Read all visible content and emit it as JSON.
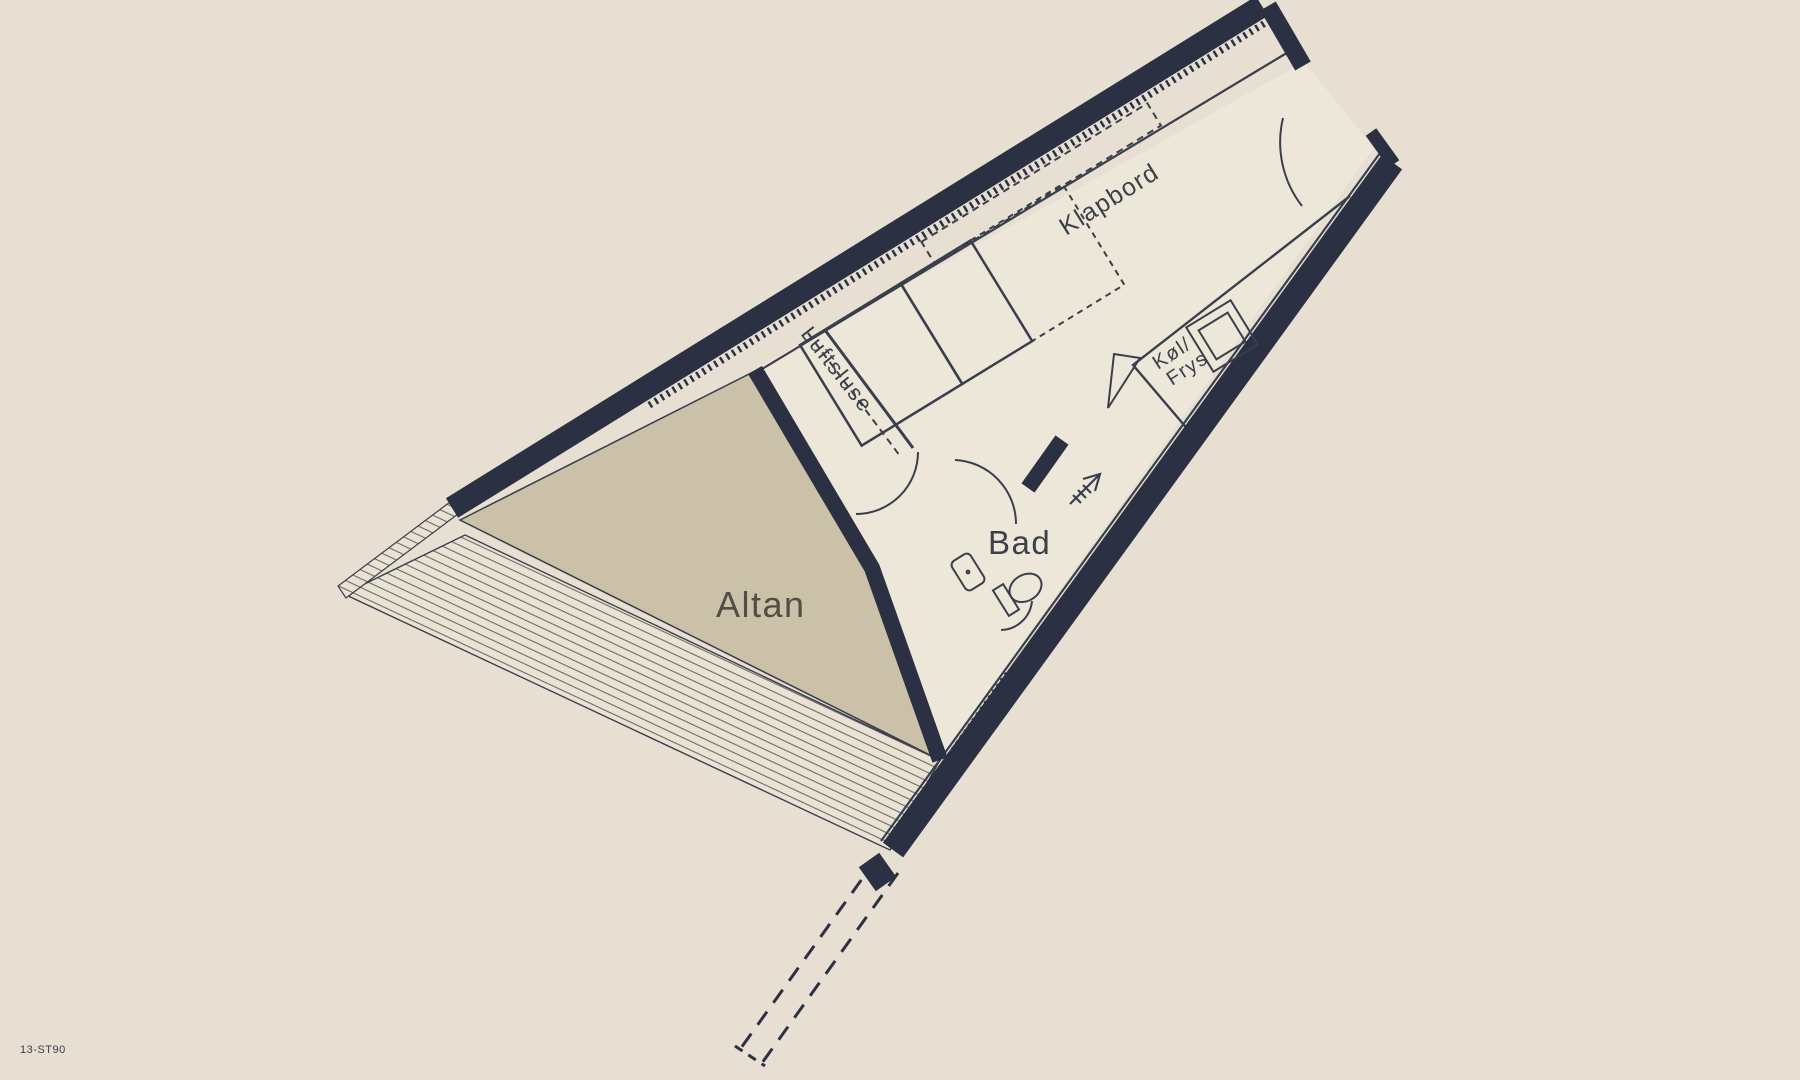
{
  "plan": {
    "drawing_number": "13-ST90",
    "rooms": {
      "altan": "Altan",
      "bad": "Bad",
      "luftsluse": "Luftsluse"
    },
    "fixtures": {
      "klapbord": "Klapbord",
      "fridge_line1": "Køl/",
      "fridge_line2": "Frys"
    },
    "symbols": [
      "entry-arrow",
      "door-swing-arc",
      "sliding-door-dashed",
      "toilet",
      "washbasin",
      "sink",
      "fold-out-table",
      "bed",
      "railing-hatch",
      "dashed-wall-continuation"
    ],
    "colors": {
      "background": "#E6DFD2",
      "floor": "#EDE7DA",
      "balcony": "#CBC0A8",
      "wall": "#2B3142",
      "line": "#3A3F4C",
      "text": "#3B4049",
      "balcony_text": "#504E45",
      "hatch_line": "#6E6C5F"
    }
  }
}
